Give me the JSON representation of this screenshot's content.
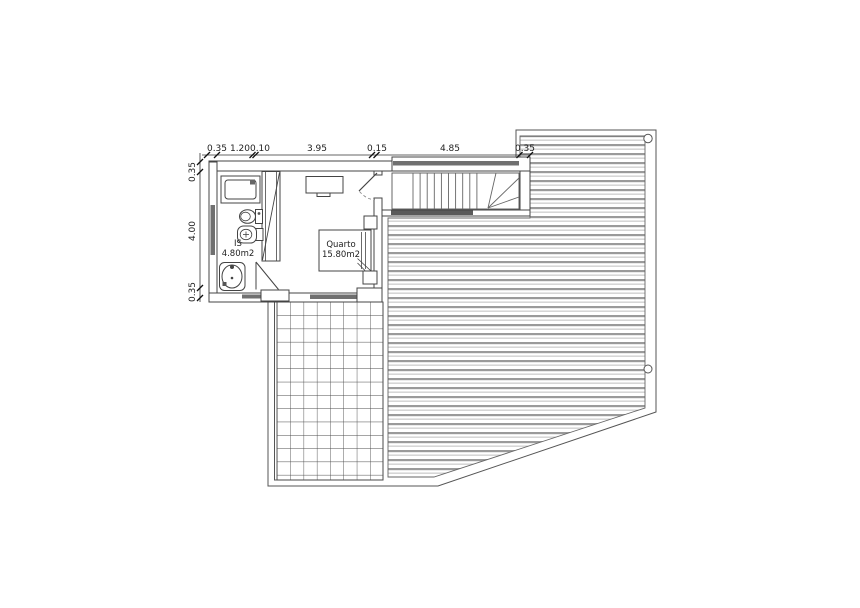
{
  "plan": {
    "dimensions_top": [
      "0.35",
      "1.20",
      "0.10",
      "3.95",
      "0.15",
      "4.85",
      "0.35"
    ],
    "dimensions_left": [
      "0.35",
      "4.00",
      "0.35"
    ],
    "rooms": [
      {
        "name": "IS",
        "area": "4.80m2"
      },
      {
        "name": "Quarto",
        "area": "15.80m2"
      }
    ],
    "colors": {
      "line": "#444444",
      "light_line": "#666666",
      "hatch_dark": "#9a9a9a",
      "hatch_light": "#c4c4c4",
      "glazing": "#707070",
      "dark_band": "#5a5a5a",
      "background": "#ffffff"
    }
  }
}
